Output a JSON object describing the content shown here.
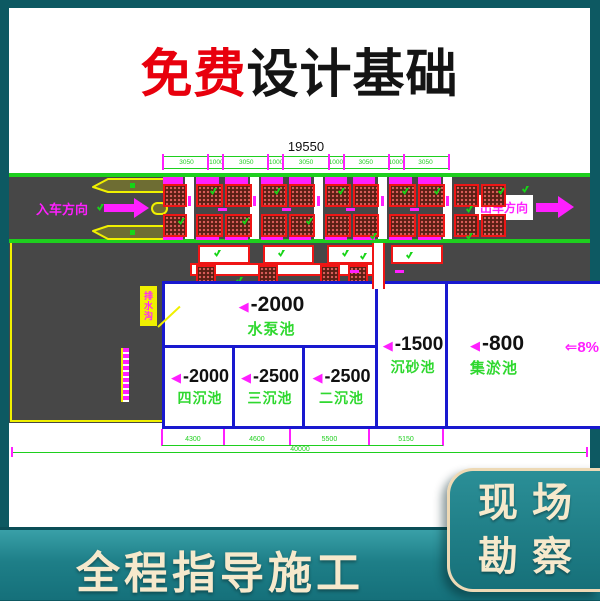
{
  "title": {
    "highlight": "免费",
    "rest": "设计基础"
  },
  "banner": {
    "text": "全程指导施工"
  },
  "corner_card": {
    "line1": "现场",
    "line2": "勘察"
  },
  "drawing": {
    "entry_label": "入车方向",
    "exit_label": "出车方向",
    "slope_label": "⇐8%",
    "callout_label": "排水沟",
    "depth_marker": "◀",
    "dims": {
      "total_top": "19550",
      "top_segments": [
        3050,
        1000,
        3050,
        1000,
        3050,
        1000,
        3050,
        1000,
        3050
      ],
      "bottom_segments": [
        4300,
        4600,
        5500,
        5150
      ],
      "total_bottom": "40000"
    },
    "pools": [
      {
        "depth": "-2000",
        "name": "水泵池"
      },
      {
        "depth": "-2000",
        "name": "四沉池"
      },
      {
        "depth": "-2500",
        "name": "三沉池"
      },
      {
        "depth": "-2500",
        "name": "二沉池"
      },
      {
        "depth": "-1500",
        "name": "沉砂池"
      },
      {
        "depth": "-800",
        "name": "集淤池"
      }
    ]
  },
  "colors": {
    "background_teal": "#0d5962",
    "banner_teal": "#1e7f88",
    "cream_text": "#f6e9cc",
    "title_red": "#e8000d",
    "cad_green": "#1ecf1e",
    "cad_magenta": "#ff1fff",
    "cad_blue": "#1818cf",
    "cad_red": "#ef1515",
    "cad_yellow": "#f0f000",
    "asphalt_gray": "#474747"
  }
}
